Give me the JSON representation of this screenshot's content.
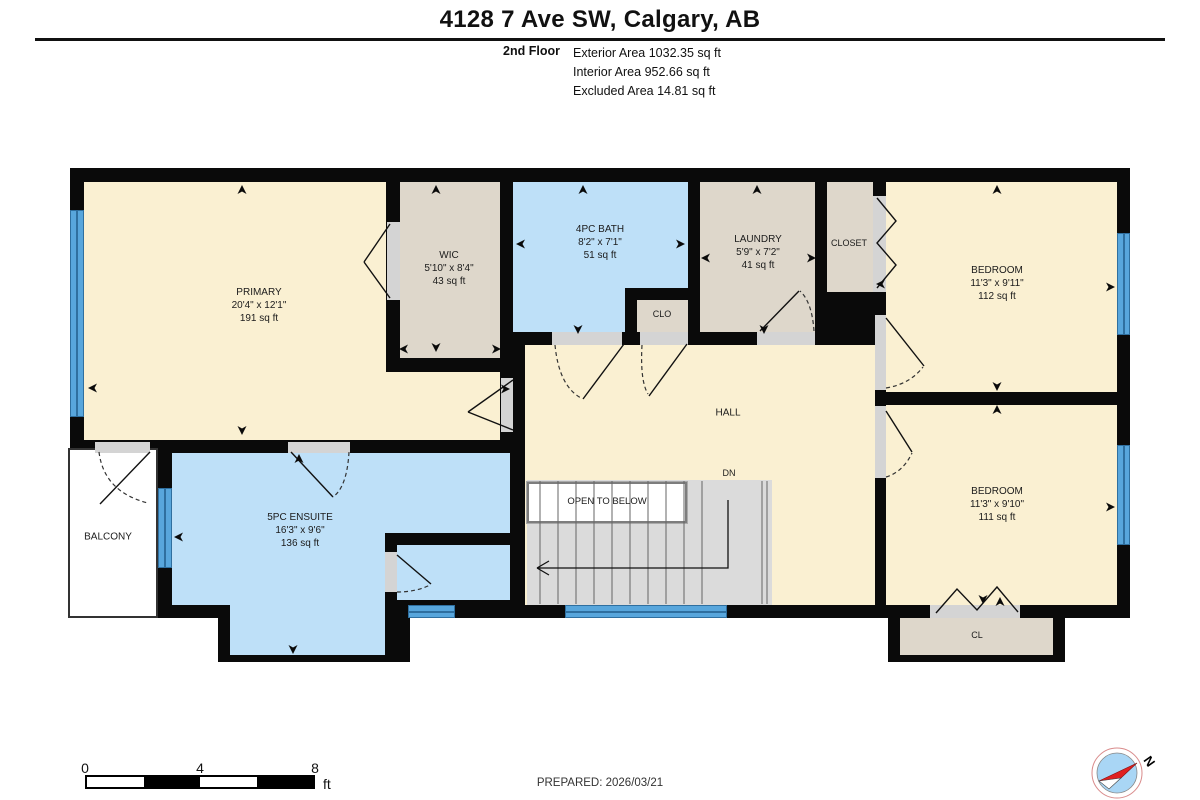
{
  "header": {
    "title": "4128 7 Ave SW, Calgary, AB",
    "floor_label": "2nd Floor",
    "area_lines": [
      "Exterior Area 1032.35 sq ft",
      "Interior Area 952.66 sq ft",
      "Excluded Area 14.81 sq ft"
    ]
  },
  "rooms": {
    "primary": {
      "name": "PRIMARY",
      "dims": "20'4\" x 12'1\"",
      "area": "191 sq ft"
    },
    "wic": {
      "name": "WIC",
      "dims": "5'10\" x 8'4\"",
      "area": "43 sq ft"
    },
    "bath": {
      "name": "4PC BATH",
      "dims": "8'2\" x 7'1\"",
      "area": "51 sq ft"
    },
    "laundry": {
      "name": "LAUNDRY",
      "dims": "5'9\" x 7'2\"",
      "area": "41 sq ft"
    },
    "closet": {
      "name": "CLOSET"
    },
    "clo": {
      "name": "CLO"
    },
    "bedroom1": {
      "name": "BEDROOM",
      "dims": "11'3\" x 9'11\"",
      "area": "112 sq ft"
    },
    "bedroom2": {
      "name": "BEDROOM",
      "dims": "11'3\" x 9'10\"",
      "area": "111 sq ft"
    },
    "hall": {
      "name": "HALL"
    },
    "dn": {
      "name": "DN"
    },
    "open_below": {
      "name": "OPEN TO BELOW"
    },
    "ensuite": {
      "name": "5PC ENSUITE",
      "dims": "16'3\" x 9'6\"",
      "area": "136 sq ft"
    },
    "balcony": {
      "name": "BALCONY"
    },
    "cl": {
      "name": "CL"
    }
  },
  "footer": {
    "scale_ticks": [
      "0",
      "4",
      "8"
    ],
    "scale_unit": "ft",
    "prepared": "PREPARED: 2026/03/21",
    "compass_label": "N"
  },
  "colors": {
    "cream": "#faf0d2",
    "tan": "#ded7cb",
    "blue": "#bee0f8",
    "window": "#58a6dc",
    "wall": "#0a0a0a",
    "stair": "#dbdbdb",
    "sill": "#d4d4d4",
    "compass_red": "#e02020"
  }
}
